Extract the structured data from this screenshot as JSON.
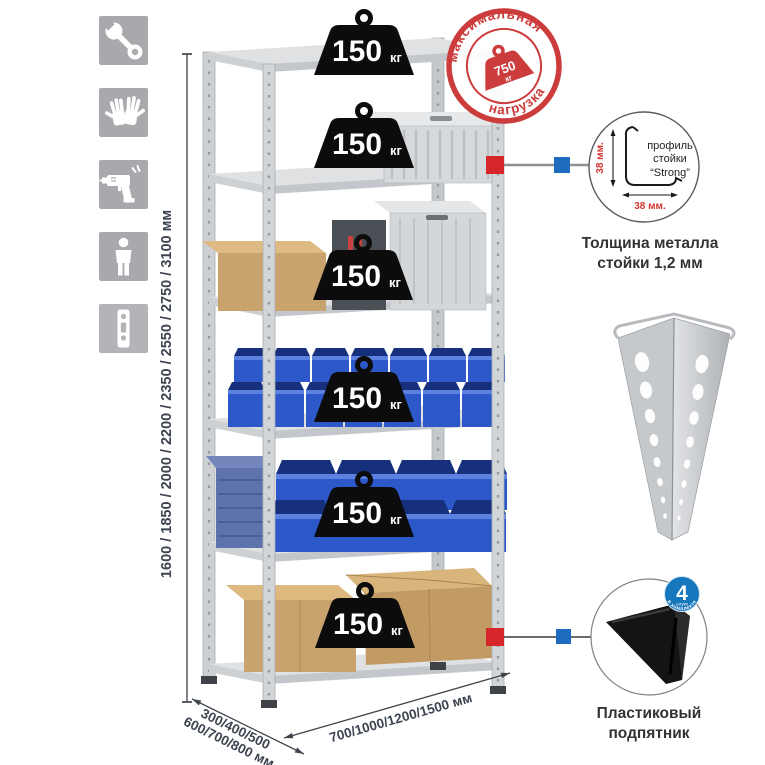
{
  "left_panel": {
    "icons": [
      "wrench",
      "gloves",
      "drill",
      "person",
      "perforated-post"
    ]
  },
  "dimensions": {
    "height": "1600 / 1850 / 2000 / 2200 / 2350 / 2550 / 2750 / 3100 мм",
    "depth_line1": "300/400/500",
    "depth_line2": "600/700/800 мм",
    "width": "700/1000/1200/1500 мм"
  },
  "rack": {
    "shelves": [
      {
        "load_value": "150",
        "load_unit": "кг"
      },
      {
        "load_value": "150",
        "load_unit": "кг"
      },
      {
        "load_value": "150",
        "load_unit": "кг"
      },
      {
        "load_value": "150",
        "load_unit": "кг"
      },
      {
        "load_value": "150",
        "load_unit": "кг"
      },
      {
        "load_value": "150",
        "load_unit": "кг"
      }
    ]
  },
  "max_load_stamp": {
    "arc_top": "максимальная",
    "arc_bottom": "нагрузка",
    "value": "750",
    "unit": "кг"
  },
  "profile_detail": {
    "dim_vertical": "38 мм.",
    "dim_horizontal": "38 мм.",
    "label_line1": "профиль",
    "label_line2": "стойки",
    "label_line3": "“Strong”",
    "caption_line1": "Толщина металла",
    "caption_line2": "стойки 1,2 мм"
  },
  "foot_detail": {
    "badge_value": "4",
    "badge_subtext": "штуки",
    "badge_arc": "в комплекте",
    "caption_line1": "Пластиковый",
    "caption_line2": "подпятник"
  },
  "colors": {
    "accent_red": "#cd3c3c",
    "marker_red": "#d6252b",
    "marker_blue": "#1e6cc0",
    "badge_blue": "#1677bd",
    "bin_blue": "#2c58c9"
  }
}
